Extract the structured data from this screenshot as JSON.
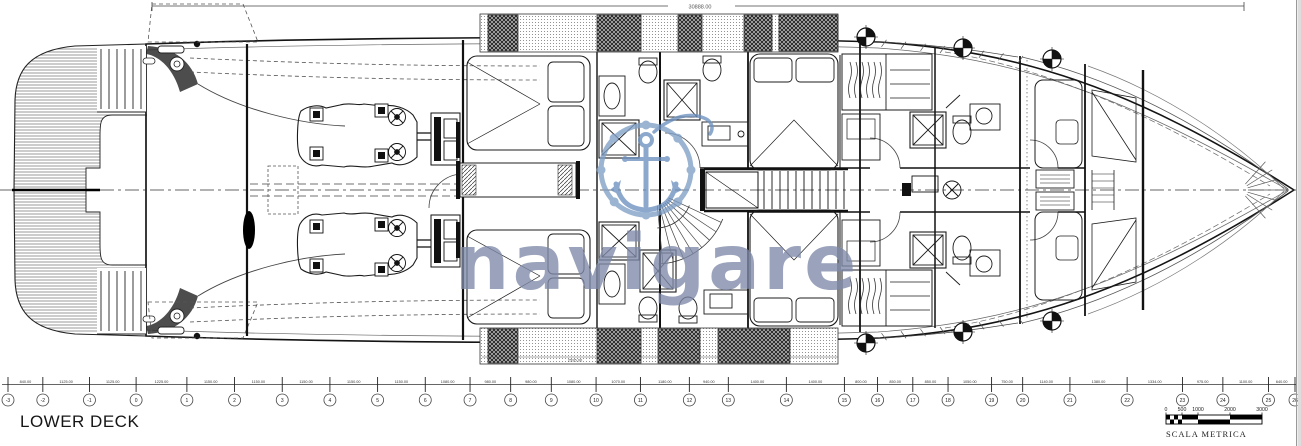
{
  "title_block": {
    "deck_label": "LOWER DECK"
  },
  "watermark": {
    "brand_text": "navigare",
    "logo_icon": "anchor-in-ships-wheel-icon",
    "text_color": "#7e8aa8",
    "logo_color": "#7f9fc6"
  },
  "dimensions": {
    "overall_length_label": "30888.00",
    "hatch_width_label": "2595.00",
    "station_labels": [
      "-3",
      "-2",
      "-1",
      "0",
      "1",
      "2",
      "3",
      "4",
      "5",
      "6",
      "7",
      "8",
      "9",
      "10",
      "11",
      "12",
      "13",
      "14",
      "15",
      "16",
      "17",
      "18",
      "19",
      "20",
      "21",
      "22",
      "23",
      "24",
      "25",
      "26"
    ],
    "station_segment_labels": [
      "840.00",
      "1125.00",
      "1125.00",
      "1225.00",
      "1150.00",
      "1150.00",
      "1150.00",
      "1150.00",
      "1150.00",
      "1080.00",
      "980.00",
      "980.00",
      "1080.00",
      "1070.00",
      "1180.00",
      "940.00",
      "1400.00",
      "1400.00",
      "800.00",
      "850.00",
      "850.00",
      "1050.00",
      "750.00",
      "1140.00",
      "1380.00",
      "1334.00",
      "975.00",
      "1100.00",
      "640.00"
    ]
  },
  "scale_bar": {
    "label": "SCALA METRICA",
    "tick_labels": [
      "0",
      "500",
      "1000",
      "2000",
      "3000"
    ],
    "max_mm": 3000
  },
  "colors": {
    "ink": "#1c1c1c",
    "paper": "#ffffff"
  }
}
